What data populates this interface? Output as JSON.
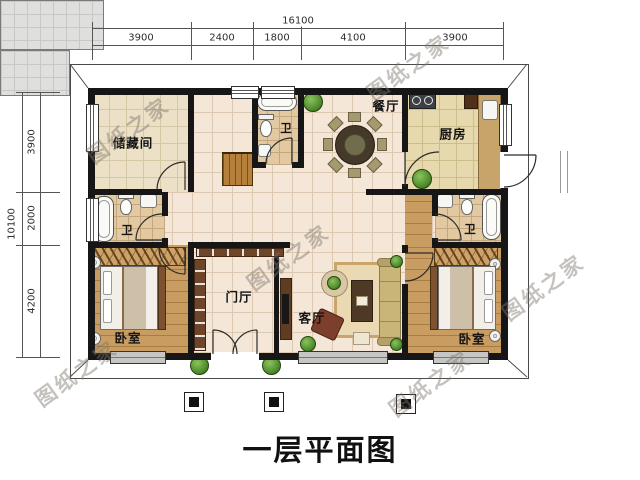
{
  "title": "一层平面图",
  "watermark": {
    "text": "图纸之家"
  },
  "dimensions": {
    "top": {
      "total": "16100",
      "segments": [
        "3900",
        "2400",
        "1800",
        "4100",
        "3900"
      ]
    },
    "left": {
      "total": "10100",
      "segments": [
        "3900",
        "2000",
        "4200"
      ]
    }
  },
  "rooms": {
    "storage": "储藏间",
    "bath_top": "卫",
    "dining": "餐厅",
    "kitchen": "厨房",
    "bath_left": "卫",
    "bath_right": "卫",
    "bedroom_left": "卧室",
    "foyer": "门厅",
    "living": "客厅",
    "bedroom_right": "卧室"
  },
  "colors": {
    "wall": "#161616",
    "wood_floor": "#c99c62",
    "tile_cream": "#ece1c6",
    "tile_pink": "#f4e7d8",
    "bath_tile": "#e3c9a2",
    "plant_green": "#4d8a2c"
  }
}
